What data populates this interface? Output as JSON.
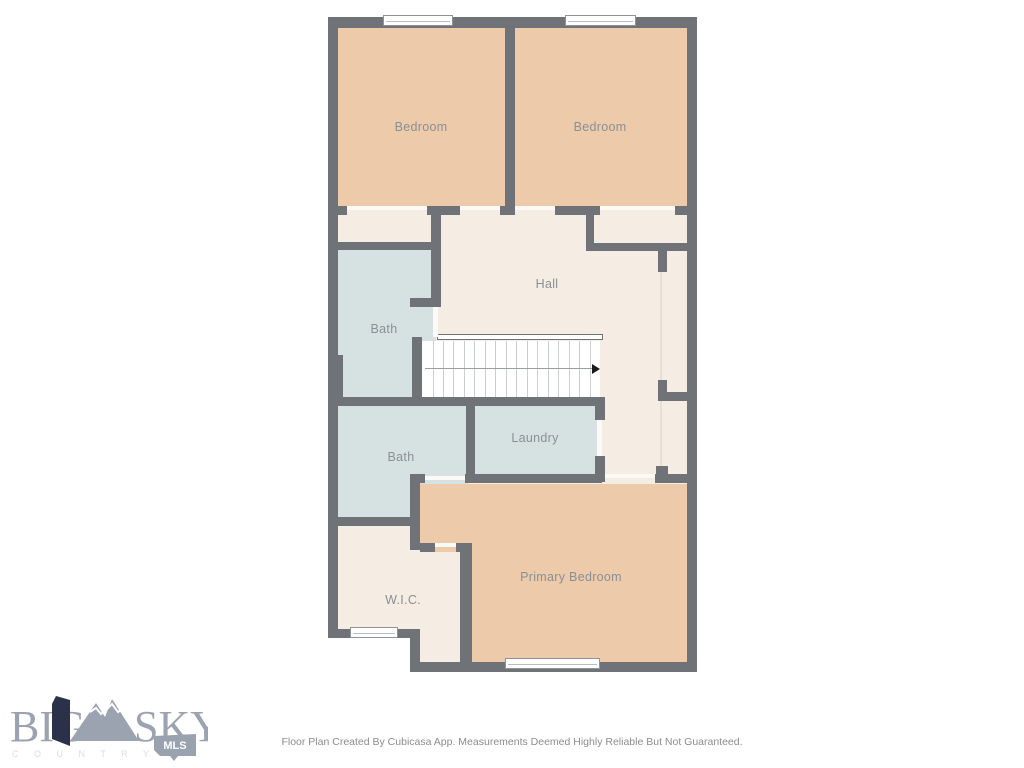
{
  "floorplan": {
    "colors": {
      "wall": "#6F7377",
      "floor": "#F5EDE4",
      "bedroom_fill": "#EDCBAA",
      "bath_fill": "#D6E2E2",
      "label_text": "#8A8F94"
    },
    "rooms": [
      {
        "id": "bedroom-1",
        "label": "Bedroom"
      },
      {
        "id": "bedroom-2",
        "label": "Bedroom"
      },
      {
        "id": "hall",
        "label": "Hall"
      },
      {
        "id": "bath-1",
        "label": "Bath"
      },
      {
        "id": "laundry",
        "label": "Laundry"
      },
      {
        "id": "bath-2",
        "label": "Bath"
      },
      {
        "id": "wic",
        "label": "W.I.C."
      },
      {
        "id": "primary-bedroom",
        "label": "Primary Bedroom"
      }
    ],
    "stairs": {
      "treads": 16,
      "direction_arrow": "right"
    }
  },
  "logo": {
    "word1": "BIG",
    "word2": "SKY",
    "subtitle": "C O U N T R Y",
    "badge": "MLS",
    "colors": {
      "text": "#9CA3B0",
      "flag": "#2B3149",
      "subtitle": "#D9DCE2",
      "badge": "#99A2AF",
      "badge_text": "#FFFFFF"
    }
  },
  "footer": {
    "disclaimer": "Floor Plan Created By Cubicasa App. Measurements Deemed Highly Reliable But Not Guaranteed."
  }
}
